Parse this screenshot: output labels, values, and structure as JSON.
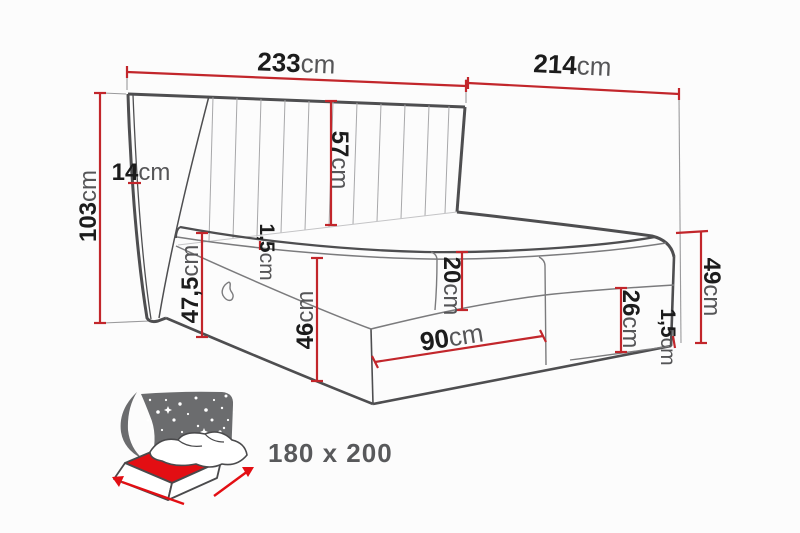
{
  "diagram": {
    "description": "bed-dimension-diagram",
    "colors": {
      "outline": "#4e4e50",
      "thin_line": "#9a9a9c",
      "dimension_red": "#c2262b",
      "number_text": "#1c1c1c",
      "unit_text": "#555557"
    },
    "dimensions": {
      "headboard_width": {
        "value": "233",
        "unit": "cm"
      },
      "total_length": {
        "value": "214",
        "unit": "cm"
      },
      "headboard_height": {
        "value": "103",
        "unit": "cm"
      },
      "headboard_depth": {
        "value": "14",
        "unit": "cm"
      },
      "headboard_above_mattress": {
        "value": "57",
        "unit": "cm"
      },
      "height_to_mattress_top": {
        "value": "47,5",
        "unit": "cm"
      },
      "top_piping": {
        "value": "1,5",
        "unit": "cm"
      },
      "base_height": {
        "value": "46",
        "unit": "cm"
      },
      "mattress_thickness": {
        "value": "20",
        "unit": "cm"
      },
      "drawer_width": {
        "value": "90",
        "unit": "cm"
      },
      "side_panel_height": {
        "value": "26",
        "unit": "cm"
      },
      "bottom_piping": {
        "value": "1,5",
        "unit": "cm"
      },
      "foot_end_height": {
        "value": "49",
        "unit": "cm"
      }
    }
  },
  "badge": {
    "size_label": "180 x 200",
    "icon_red": "#e30e13",
    "icon_gray": "#6b6c6e",
    "icon_outline": "#4a4a4c"
  }
}
